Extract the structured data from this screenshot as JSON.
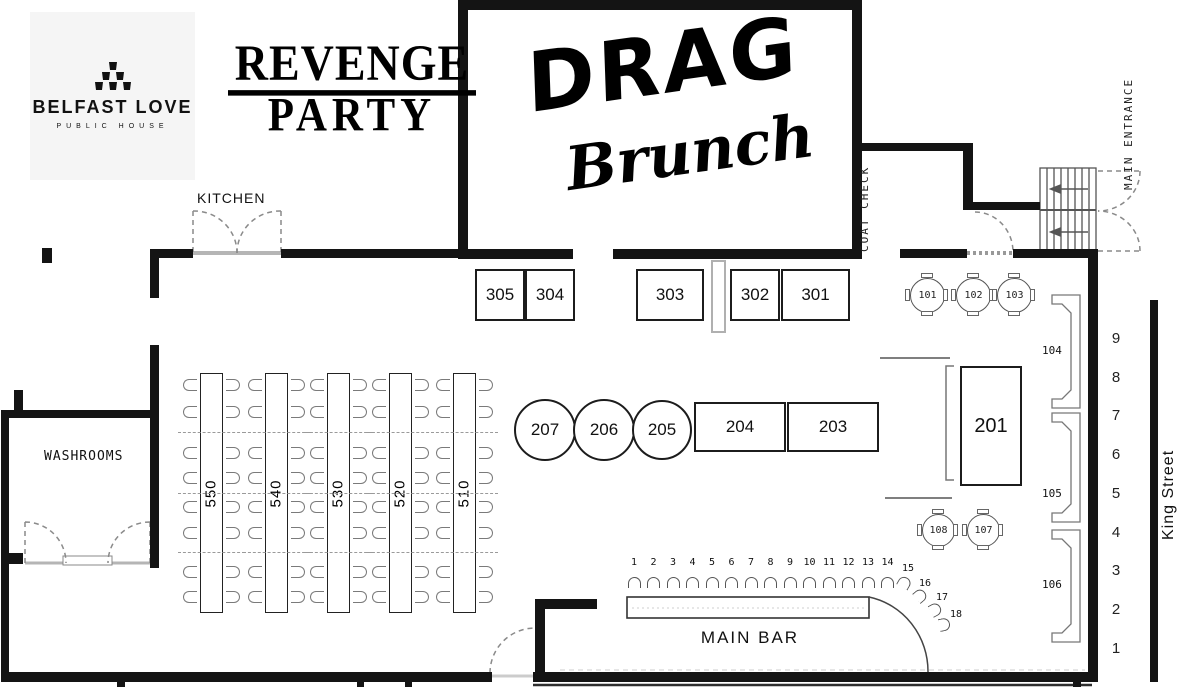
{
  "branding": {
    "venue_name": "BELFAST LOVE",
    "venue_tagline": "PUBLIC HOUSE",
    "event_title_line1": "REVENGE",
    "event_title_line2": "PARTY",
    "show_title_line1": "DRAG",
    "show_title_line2": "Brunch"
  },
  "labels": {
    "kitchen": "KITCHEN",
    "washrooms": "WASHROOMS",
    "coat_check": "COAT CHECK",
    "main_entrance": "MAIN ENTRANCE",
    "street": "King Street"
  },
  "tables": {
    "row_300": [
      "305",
      "304",
      "303",
      "302",
      "301"
    ],
    "round_100": [
      "101",
      "102",
      "103"
    ],
    "booths": [
      "104",
      "105",
      "106"
    ],
    "banquette_200": "201",
    "round_200": [
      "207",
      "206",
      "205"
    ],
    "rect_200": [
      "204",
      "203"
    ],
    "round_100b": [
      "108",
      "107"
    ],
    "long_500": [
      "550",
      "540",
      "530",
      "520",
      "510"
    ]
  },
  "bar": {
    "label": "MAIN BAR",
    "seats": [
      "1",
      "2",
      "3",
      "4",
      "5",
      "6",
      "7",
      "8",
      "9",
      "10",
      "11",
      "12",
      "13",
      "14",
      "15",
      "16",
      "17",
      "18"
    ]
  },
  "street_seat_numbers": [
    "9",
    "8",
    "7",
    "6",
    "5",
    "4",
    "3",
    "2",
    "1"
  ],
  "colors": {
    "wall": "#141414",
    "line": "#555555",
    "muted": "#9a9a9a",
    "logo_bg": "#f5f5f5"
  }
}
